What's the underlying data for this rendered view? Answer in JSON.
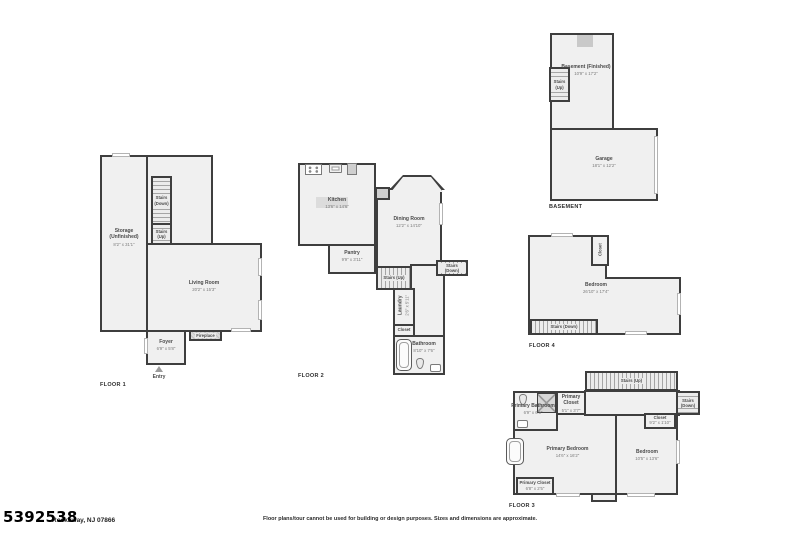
{
  "meta": {
    "listing_number": "5392538",
    "address": "Rockaway, NJ 07866",
    "disclaimer": "Floor plans/tour cannot be used for building or design purposes. Sizes and dimensions are approximate."
  },
  "floor1": {
    "label": "FLOOR 1",
    "storage_name": "Storage (Unfinished)",
    "storage_dims": "8'2\" x 31'1\"",
    "stairs_down": "Stairs (Down)",
    "stairs_up": "Stairs (Up)",
    "living_name": "Living Room",
    "living_dims": "20'2\" x 15'3\"",
    "fireplace": "Fireplace",
    "foyer_name": "Foyer",
    "foyer_dims": "6'9\" x 5'8\"",
    "entry": "Entry"
  },
  "floor2": {
    "label": "FLOOR 2",
    "kitchen_name": "Kitchen",
    "kitchen_dims": "13'6\" x 14'6\"",
    "dining_name": "Dining Room",
    "dining_dims": "12'2\" x 14'10\"",
    "pantry_name": "Pantry",
    "pantry_dims": "9'9\" x 3'11\"",
    "stairs_up": "Stairs (Up)",
    "stairs_down": "Stairs (Down)",
    "laundry_name": "Laundry",
    "laundry_dims": "2'6\" x 5'11\"",
    "closet": "Closet",
    "bathroom_name": "Bathroom",
    "bathroom_dims": "8'10\" x 7'6\""
  },
  "basement": {
    "label": "BASEMENT",
    "finished_name": "Basement (Finished)",
    "finished_dims": "10'9\" x 17'2\"",
    "stairs_up": "Stairs (Up)",
    "garage_name": "Garage",
    "garage_dims": "18'1\" x 12'2\""
  },
  "floor4": {
    "label": "FLOOR 4",
    "closet": "Closet",
    "bedroom_name": "Bedroom",
    "bedroom_dims": "26'10\" x 17'4\"",
    "stairs_down": "Stairs (Down)"
  },
  "floor3": {
    "label": "FLOOR 3",
    "stairs_up": "Stairs (Up)",
    "stairs_down": "Stairs (Down)",
    "primary_closet_top_name": "Primary Closet",
    "primary_closet_top_dims": "5'1\" x 3'7\"",
    "primary_bathroom_name": "Primary Bathroom",
    "primary_bathroom_dims": "6'9\" x 6'5\"",
    "closet_name": "Closet",
    "closet_dims": "9'2\" x 1'10\"",
    "primary_bedroom_name": "Primary Bedroom",
    "primary_bedroom_dims": "14'6\" x 16'2\"",
    "bedroom_name": "Bedroom",
    "bedroom_dims": "10'5\" x 13'6\"",
    "primary_closet_bottom_name": "Primary Closet",
    "primary_closet_bottom_dims": "6'8\" x 2'5\""
  }
}
